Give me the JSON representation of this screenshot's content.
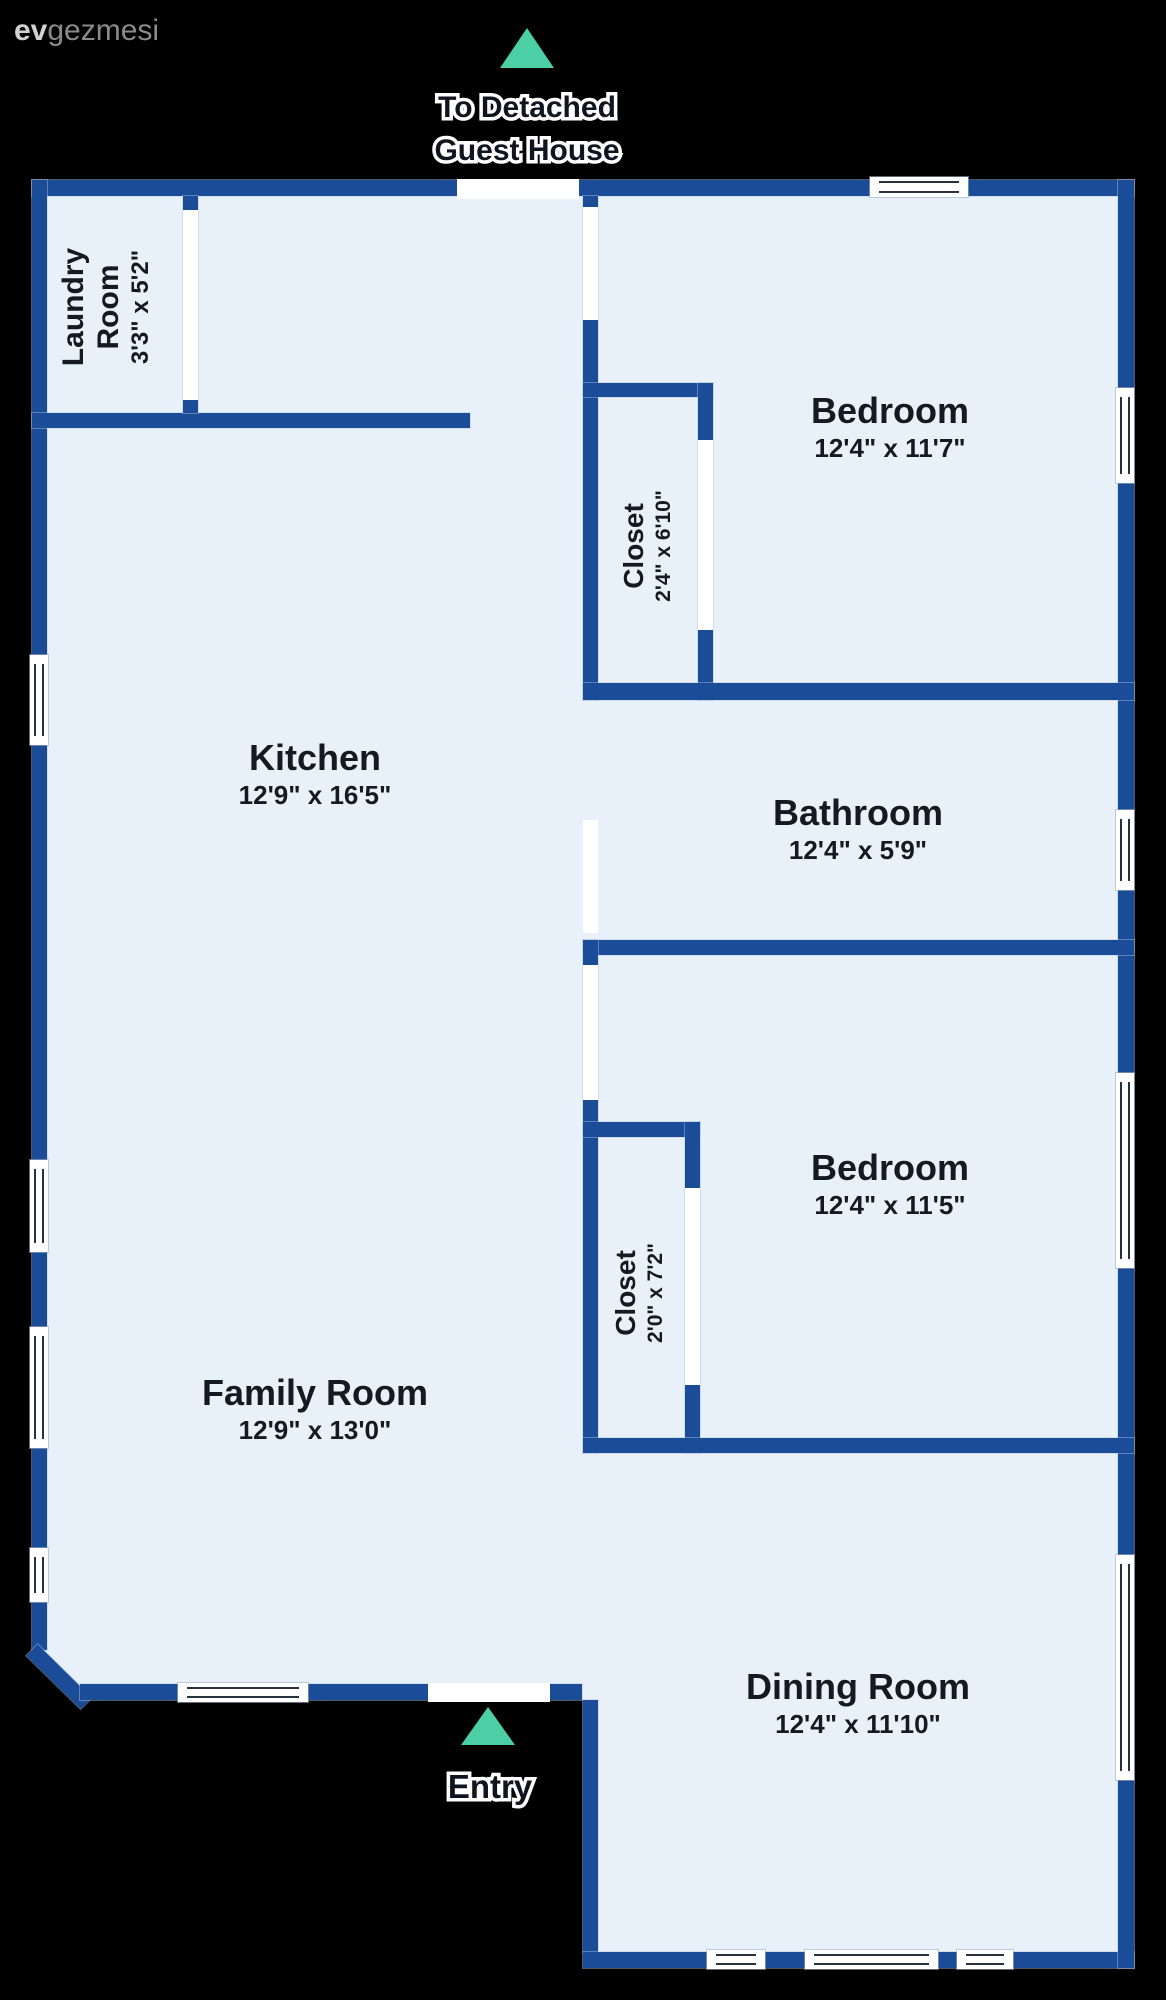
{
  "logo": {
    "bold": "ev",
    "rest": "gezmesi"
  },
  "annotations": {
    "guest_house": {
      "line1": "To Detached",
      "line2": "Guest House"
    },
    "entry": {
      "label": "Entry"
    }
  },
  "rooms": [
    {
      "name": "Laundry Room",
      "dims": "3'3\" x 5'2\""
    },
    {
      "name": "Kitchen",
      "dims": "12'9\" x 16'5\""
    },
    {
      "name": "Family Room",
      "dims": "12'9\" x 13'0\""
    },
    {
      "name": "Bedroom",
      "dims": "12'4\" x 11'7\""
    },
    {
      "name": "Closet",
      "dims": "2'4\" x 6'10\""
    },
    {
      "name": "Bathroom",
      "dims": "12'4\" x 5'9\""
    },
    {
      "name": "Bedroom",
      "dims": "12'4\" x 11'5\""
    },
    {
      "name": "Closet",
      "dims": "2'0\" x 7'2\""
    },
    {
      "name": "Dining Room",
      "dims": "12'4\" x 11'10\""
    }
  ],
  "icons": {
    "top_arrow": "up-triangle",
    "entry_arrow": "up-triangle"
  },
  "colors": {
    "wall": "#1a4c98",
    "floor": "#e8f1fa",
    "arrow": "#4ccfa4",
    "background": "#000000"
  }
}
